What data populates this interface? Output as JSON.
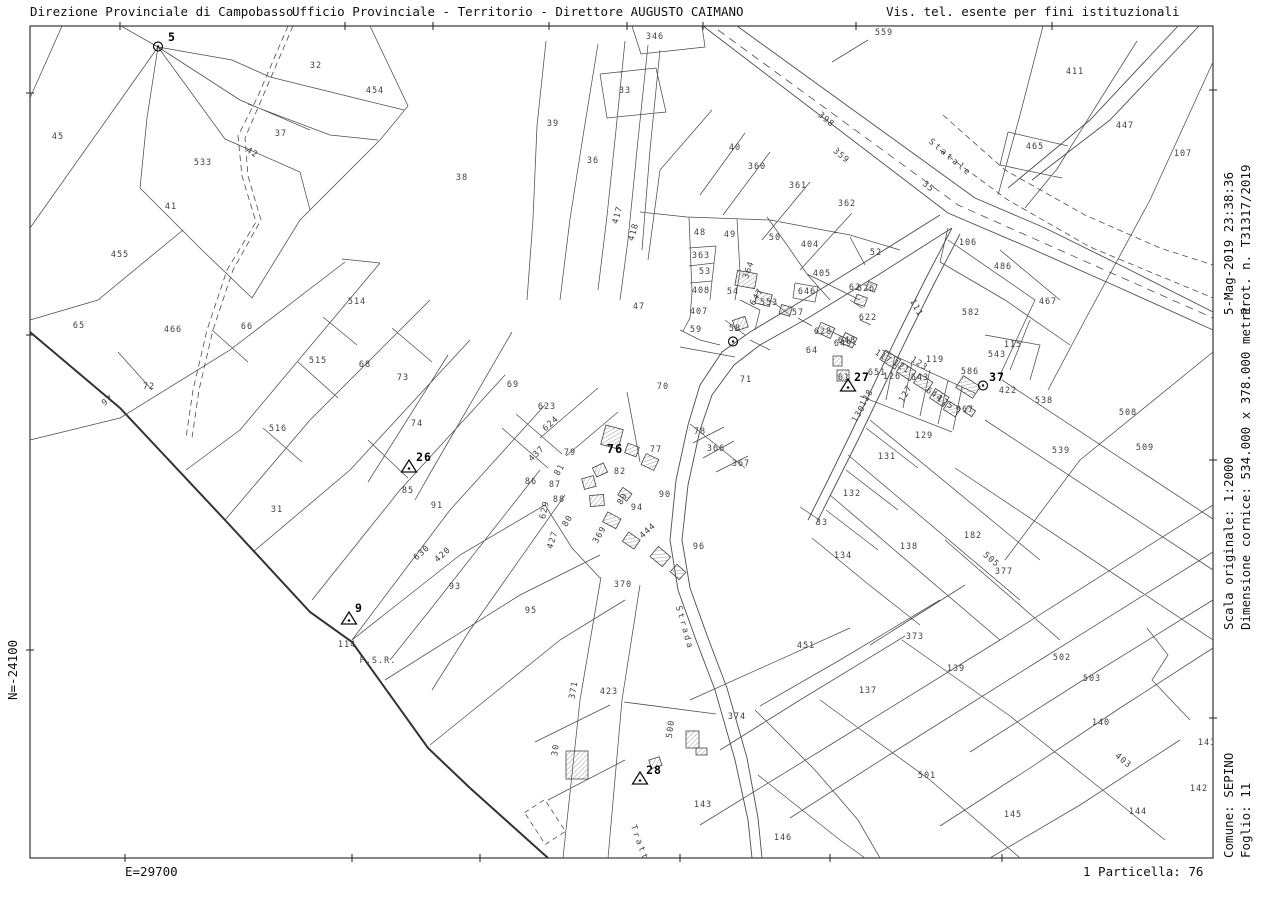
{
  "header": {
    "left": "Direzione Provinciale di Campobasso",
    "center": "Ufficio Provinciale - Territorio - Direttore AUGUSTO CAIMANO",
    "right": "Vis. tel. esente per fini istituzionali"
  },
  "margins": {
    "right_top_line1": "5-Mag-2019 23:38:36",
    "right_top_line2": "Prot. n. T31317/2019",
    "right_mid_line1": "Scala originale: 1:2000",
    "right_mid_line2": "Dimensione cornice: 534.000 x 378.000 metri",
    "right_bottom_line1": "Comune: SEPINO",
    "right_bottom_line2": "Foglio: 11",
    "left_coord": "N=-24100",
    "bottom_left": "E=29700",
    "bottom_right": "1 Particella: 76"
  },
  "map": {
    "road_names": [
      {
        "text": "Statale",
        "x": 950,
        "y": 158,
        "r": 40
      },
      {
        "text": "Strada",
        "x": 684,
        "y": 628,
        "r": 74
      },
      {
        "text": "Tratturo",
        "x": 643,
        "y": 854,
        "r": 70
      }
    ],
    "markers": [
      {
        "type": "circle",
        "label": "5",
        "x": 158,
        "y": 47,
        "lx": 172,
        "ly": 37
      },
      {
        "type": "circle",
        "label": "37",
        "x": 983,
        "y": 386,
        "lx": 997,
        "ly": 377
      },
      {
        "type": "circle",
        "label": "",
        "x": 733,
        "y": 342,
        "lx": 0,
        "ly": 0
      },
      {
        "type": "triangle",
        "label": "26",
        "x": 409,
        "y": 468,
        "lx": 424,
        "ly": 457
      },
      {
        "type": "triangle",
        "label": "27",
        "x": 848,
        "y": 387,
        "lx": 862,
        "ly": 377
      },
      {
        "type": "triangle",
        "label": "28",
        "x": 640,
        "y": 780,
        "lx": 654,
        "ly": 770
      },
      {
        "type": "triangle",
        "label": "9",
        "x": 349,
        "y": 620,
        "lx": 359,
        "ly": 608
      }
    ],
    "parcels": [
      {
        "t": "45",
        "x": 58,
        "y": 137
      },
      {
        "t": "32",
        "x": 316,
        "y": 66
      },
      {
        "t": "454",
        "x": 375,
        "y": 91
      },
      {
        "t": "37",
        "x": 281,
        "y": 134
      },
      {
        "t": "42",
        "x": 252,
        "y": 153,
        "r": 30
      },
      {
        "t": "533",
        "x": 203,
        "y": 163
      },
      {
        "t": "41",
        "x": 171,
        "y": 207
      },
      {
        "t": "38",
        "x": 462,
        "y": 178
      },
      {
        "t": "39",
        "x": 553,
        "y": 124
      },
      {
        "t": "33",
        "x": 625,
        "y": 91
      },
      {
        "t": "36",
        "x": 593,
        "y": 161
      },
      {
        "t": "346",
        "x": 655,
        "y": 37
      },
      {
        "t": "417",
        "x": 618,
        "y": 215,
        "r": -75
      },
      {
        "t": "418",
        "x": 634,
        "y": 232,
        "r": -75
      },
      {
        "t": "47",
        "x": 639,
        "y": 307
      },
      {
        "t": "559",
        "x": 884,
        "y": 33
      },
      {
        "t": "40",
        "x": 735,
        "y": 148
      },
      {
        "t": "360",
        "x": 757,
        "y": 167
      },
      {
        "t": "361",
        "x": 798,
        "y": 186
      },
      {
        "t": "362",
        "x": 847,
        "y": 204
      },
      {
        "t": "398",
        "x": 826,
        "y": 120,
        "r": 40
      },
      {
        "t": "359",
        "x": 841,
        "y": 156,
        "r": 40
      },
      {
        "t": "35",
        "x": 928,
        "y": 187,
        "r": 40
      },
      {
        "t": "411",
        "x": 1075,
        "y": 72
      },
      {
        "t": "447",
        "x": 1125,
        "y": 126
      },
      {
        "t": "465",
        "x": 1035,
        "y": 147
      },
      {
        "t": "107",
        "x": 1183,
        "y": 154
      },
      {
        "t": "106",
        "x": 968,
        "y": 243
      },
      {
        "t": "486",
        "x": 1003,
        "y": 267
      },
      {
        "t": "467",
        "x": 1048,
        "y": 302
      },
      {
        "t": "48",
        "x": 700,
        "y": 233
      },
      {
        "t": "49",
        "x": 730,
        "y": 235
      },
      {
        "t": "50",
        "x": 775,
        "y": 238
      },
      {
        "t": "404",
        "x": 810,
        "y": 245
      },
      {
        "t": "52",
        "x": 876,
        "y": 253
      },
      {
        "t": "363",
        "x": 701,
        "y": 256
      },
      {
        "t": "364",
        "x": 749,
        "y": 270,
        "r": -70
      },
      {
        "t": "53",
        "x": 705,
        "y": 272
      },
      {
        "t": "405",
        "x": 822,
        "y": 274
      },
      {
        "t": "408",
        "x": 701,
        "y": 291
      },
      {
        "t": "54",
        "x": 733,
        "y": 292
      },
      {
        "t": "646",
        "x": 807,
        "y": 292
      },
      {
        "t": "647",
        "x": 757,
        "y": 297,
        "r": -60
      },
      {
        "t": "553",
        "x": 769,
        "y": 303
      },
      {
        "t": "57",
        "x": 798,
        "y": 313
      },
      {
        "t": "407",
        "x": 699,
        "y": 312
      },
      {
        "t": "59",
        "x": 696,
        "y": 330
      },
      {
        "t": "58",
        "x": 735,
        "y": 329
      },
      {
        "t": "64",
        "x": 812,
        "y": 351
      },
      {
        "t": "628",
        "x": 823,
        "y": 332
      },
      {
        "t": "648",
        "x": 847,
        "y": 341
      },
      {
        "t": "62",
        "x": 855,
        "y": 288
      },
      {
        "t": "626",
        "x": 866,
        "y": 289
      },
      {
        "t": "622",
        "x": 868,
        "y": 318
      },
      {
        "t": "111",
        "x": 916,
        "y": 308,
        "r": 62
      },
      {
        "t": "582",
        "x": 971,
        "y": 313
      },
      {
        "t": "115",
        "x": 1013,
        "y": 345
      },
      {
        "t": "543",
        "x": 997,
        "y": 355
      },
      {
        "t": "119",
        "x": 935,
        "y": 360
      },
      {
        "t": "117",
        "x": 883,
        "y": 357,
        "r": 33
      },
      {
        "t": "121",
        "x": 901,
        "y": 367,
        "r": 33
      },
      {
        "t": "123",
        "x": 919,
        "y": 364,
        "r": 33
      },
      {
        "t": "643",
        "x": 920,
        "y": 378
      },
      {
        "t": "644",
        "x": 934,
        "y": 395,
        "r": 33
      },
      {
        "t": "125",
        "x": 945,
        "y": 403,
        "r": 33
      },
      {
        "t": "967",
        "x": 965,
        "y": 410
      },
      {
        "t": "586",
        "x": 970,
        "y": 372
      },
      {
        "t": "422",
        "x": 1008,
        "y": 391
      },
      {
        "t": "61",
        "x": 844,
        "y": 378
      },
      {
        "t": "651",
        "x": 877,
        "y": 373
      },
      {
        "t": "126",
        "x": 892,
        "y": 377
      },
      {
        "t": "128",
        "x": 867,
        "y": 398,
        "r": -60
      },
      {
        "t": "127",
        "x": 906,
        "y": 394,
        "r": -60
      },
      {
        "t": "130",
        "x": 859,
        "y": 414,
        "r": -60
      },
      {
        "t": "649",
        "x": 843,
        "y": 344
      },
      {
        "t": "455",
        "x": 120,
        "y": 255
      },
      {
        "t": "65",
        "x": 79,
        "y": 326
      },
      {
        "t": "466",
        "x": 173,
        "y": 330
      },
      {
        "t": "66",
        "x": 247,
        "y": 327
      },
      {
        "t": "514",
        "x": 357,
        "y": 302
      },
      {
        "t": "515",
        "x": 318,
        "y": 361
      },
      {
        "t": "68",
        "x": 365,
        "y": 365
      },
      {
        "t": "72",
        "x": 149,
        "y": 387
      },
      {
        "t": "97",
        "x": 108,
        "y": 401,
        "r": -35
      },
      {
        "t": "516",
        "x": 278,
        "y": 429
      },
      {
        "t": "31",
        "x": 277,
        "y": 510
      },
      {
        "t": "73",
        "x": 403,
        "y": 378
      },
      {
        "t": "69",
        "x": 513,
        "y": 385
      },
      {
        "t": "623",
        "x": 547,
        "y": 407
      },
      {
        "t": "624",
        "x": 551,
        "y": 424,
        "r": -42
      },
      {
        "t": "74",
        "x": 417,
        "y": 424
      },
      {
        "t": "85",
        "x": 408,
        "y": 491
      },
      {
        "t": "91",
        "x": 437,
        "y": 506
      },
      {
        "t": "437",
        "x": 537,
        "y": 454,
        "r": -45
      },
      {
        "t": "79",
        "x": 570,
        "y": 453
      },
      {
        "t": "77",
        "x": 656,
        "y": 450
      },
      {
        "t": "81",
        "x": 560,
        "y": 470,
        "r": -60
      },
      {
        "t": "86",
        "x": 531,
        "y": 482
      },
      {
        "t": "87",
        "x": 555,
        "y": 485
      },
      {
        "t": "88",
        "x": 559,
        "y": 500
      },
      {
        "t": "82",
        "x": 620,
        "y": 472
      },
      {
        "t": "80",
        "x": 568,
        "y": 521,
        "r": -60
      },
      {
        "t": "89",
        "x": 623,
        "y": 499,
        "r": -60
      },
      {
        "t": "94",
        "x": 637,
        "y": 508
      },
      {
        "t": "444",
        "x": 648,
        "y": 531,
        "r": -42
      },
      {
        "t": "90",
        "x": 665,
        "y": 495
      },
      {
        "t": "70",
        "x": 663,
        "y": 387
      },
      {
        "t": "71",
        "x": 746,
        "y": 380
      },
      {
        "t": "78",
        "x": 700,
        "y": 432
      },
      {
        "t": "366",
        "x": 716,
        "y": 449
      },
      {
        "t": "367",
        "x": 741,
        "y": 464
      },
      {
        "t": "629",
        "x": 545,
        "y": 510,
        "r": -78
      },
      {
        "t": "427",
        "x": 553,
        "y": 540,
        "r": -72
      },
      {
        "t": "630",
        "x": 422,
        "y": 553,
        "r": -42
      },
      {
        "t": "420",
        "x": 443,
        "y": 555,
        "r": -42
      },
      {
        "t": "76",
        "x": 615,
        "y": 449,
        "b": true
      },
      {
        "t": "129",
        "x": 924,
        "y": 436
      },
      {
        "t": "131",
        "x": 887,
        "y": 457
      },
      {
        "t": "132",
        "x": 852,
        "y": 494
      },
      {
        "t": "33",
        "x": 822,
        "y": 523
      },
      {
        "t": "138",
        "x": 909,
        "y": 547
      },
      {
        "t": "182",
        "x": 973,
        "y": 536
      },
      {
        "t": "377",
        "x": 1004,
        "y": 572
      },
      {
        "t": "505",
        "x": 991,
        "y": 560,
        "r": 40
      },
      {
        "t": "538",
        "x": 1044,
        "y": 401
      },
      {
        "t": "539",
        "x": 1061,
        "y": 451
      },
      {
        "t": "508",
        "x": 1128,
        "y": 413
      },
      {
        "t": "509",
        "x": 1145,
        "y": 448
      },
      {
        "t": "134",
        "x": 843,
        "y": 556
      },
      {
        "t": "93",
        "x": 455,
        "y": 587
      },
      {
        "t": "95",
        "x": 531,
        "y": 611
      },
      {
        "t": "370",
        "x": 623,
        "y": 585
      },
      {
        "t": "114",
        "x": 347,
        "y": 645
      },
      {
        "t": "P.S.R.",
        "x": 378,
        "y": 661
      },
      {
        "t": "371",
        "x": 574,
        "y": 690,
        "r": -80
      },
      {
        "t": "423",
        "x": 609,
        "y": 692
      },
      {
        "t": "96",
        "x": 699,
        "y": 547
      },
      {
        "t": "374",
        "x": 737,
        "y": 717
      },
      {
        "t": "451",
        "x": 806,
        "y": 646
      },
      {
        "t": "137",
        "x": 868,
        "y": 691
      },
      {
        "t": "373",
        "x": 915,
        "y": 637
      },
      {
        "t": "139",
        "x": 956,
        "y": 669
      },
      {
        "t": "30",
        "x": 556,
        "y": 750,
        "r": -82
      },
      {
        "t": "500",
        "x": 671,
        "y": 729,
        "r": -82
      },
      {
        "t": "369",
        "x": 600,
        "y": 535,
        "r": -60
      },
      {
        "t": "143",
        "x": 703,
        "y": 805
      },
      {
        "t": "146",
        "x": 783,
        "y": 838
      },
      {
        "t": "501",
        "x": 927,
        "y": 776
      },
      {
        "t": "502",
        "x": 1062,
        "y": 658
      },
      {
        "t": "503",
        "x": 1092,
        "y": 679
      },
      {
        "t": "140",
        "x": 1101,
        "y": 723
      },
      {
        "t": "403",
        "x": 1123,
        "y": 761,
        "r": 40
      },
      {
        "t": "141",
        "x": 1207,
        "y": 743
      },
      {
        "t": "142",
        "x": 1199,
        "y": 789
      },
      {
        "t": "145",
        "x": 1013,
        "y": 815
      },
      {
        "t": "144",
        "x": 1138,
        "y": 812
      }
    ]
  }
}
